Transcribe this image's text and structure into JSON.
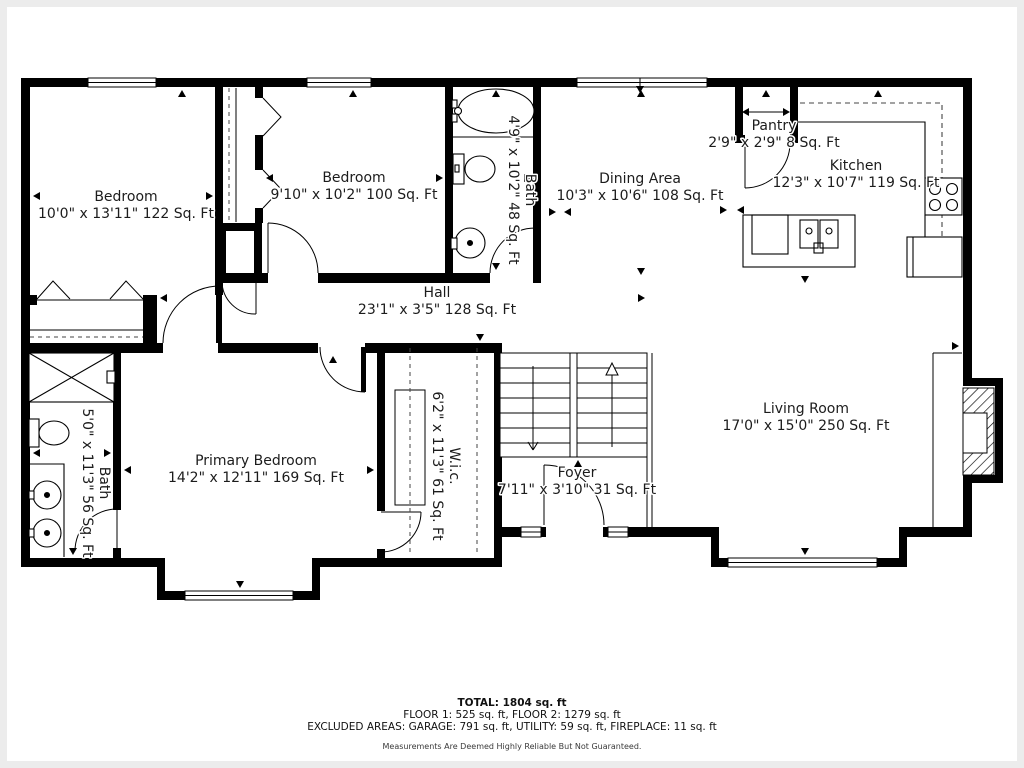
{
  "floor_plan": {
    "rooms": [
      {
        "id": "bedroom-upper-left",
        "name": "Bedroom",
        "dims": "10'0\" x 13'11\" 122 Sq. Ft"
      },
      {
        "id": "bedroom-upper-middle",
        "name": "Bedroom",
        "dims": "9'10\" x 10'2\" 100 Sq. Ft"
      },
      {
        "id": "bath-upper",
        "name": "Bath",
        "dims": "4'9\" x 10'2\" 48 Sq. Ft"
      },
      {
        "id": "dining-area",
        "name": "Dining Area",
        "dims": "10'3\" x 10'6\" 108 Sq. Ft"
      },
      {
        "id": "pantry",
        "name": "Pantry",
        "dims": "2'9\" x 2'9\" 8 Sq. Ft"
      },
      {
        "id": "kitchen",
        "name": "Kitchen",
        "dims": "12'3\" x 10'7\" 119 Sq. Ft"
      },
      {
        "id": "hall",
        "name": "Hall",
        "dims": "23'1\" x 3'5\" 128 Sq. Ft"
      },
      {
        "id": "primary-bedroom",
        "name": "Primary Bedroom",
        "dims": "14'2\" x 12'11\" 169 Sq. Ft"
      },
      {
        "id": "bath-primary",
        "name": "Bath",
        "dims": "5'0\" x 11'3\" 56 Sq. Ft"
      },
      {
        "id": "walk-in-closet",
        "name": "W.i.c.",
        "dims": "6'2\" x 11'3\" 61 Sq. Ft"
      },
      {
        "id": "foyer",
        "name": "Foyer",
        "dims": "7'11\" x 3'10\" 31 Sq. Ft"
      },
      {
        "id": "living-room",
        "name": "Living Room",
        "dims": "17'0\" x 15'0\" 250 Sq. Ft"
      }
    ],
    "footer": {
      "total": "TOTAL: 1804 sq. ft",
      "floors": "FLOOR 1: 525 sq. ft, FLOOR 2: 1279 sq. ft",
      "excluded": "EXCLUDED AREAS: GARAGE: 791 sq. ft, UTILITY: 59 sq. ft, FIREPLACE: 11 sq. ft",
      "disclaimer": "Measurements Are Deemed Highly Reliable But Not Guaranteed."
    },
    "colors": {
      "wall": "#000000",
      "background": "#ffffff",
      "frame": "#ececec",
      "text": "#1c1c1c"
    }
  }
}
